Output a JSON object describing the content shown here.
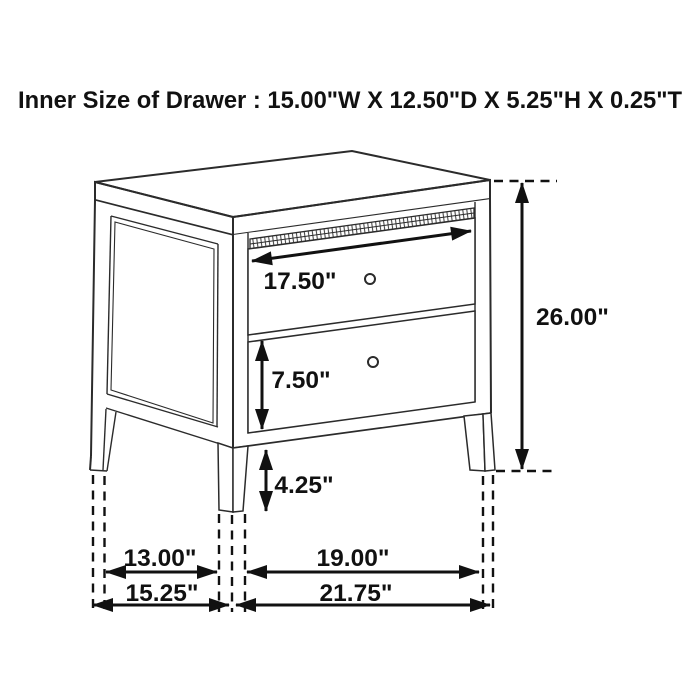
{
  "header": {
    "title": "Inner Size of Drawer : 15.00\"W X 12.50\"D X 5.25\"H X 0.25\"T"
  },
  "diagram": {
    "labels": {
      "top_drawer_width": "17.50\"",
      "overall_height": "26.00\"",
      "bottom_drawer_height": "7.50\"",
      "leg_height": "4.25\"",
      "inner_depth": "13.00\"",
      "inner_width": "19.00\"",
      "overall_depth": "15.25\"",
      "overall_width": "21.75\""
    },
    "colors": {
      "line": "#2b2b2b",
      "dimension": "#111111",
      "background": "#ffffff"
    }
  }
}
